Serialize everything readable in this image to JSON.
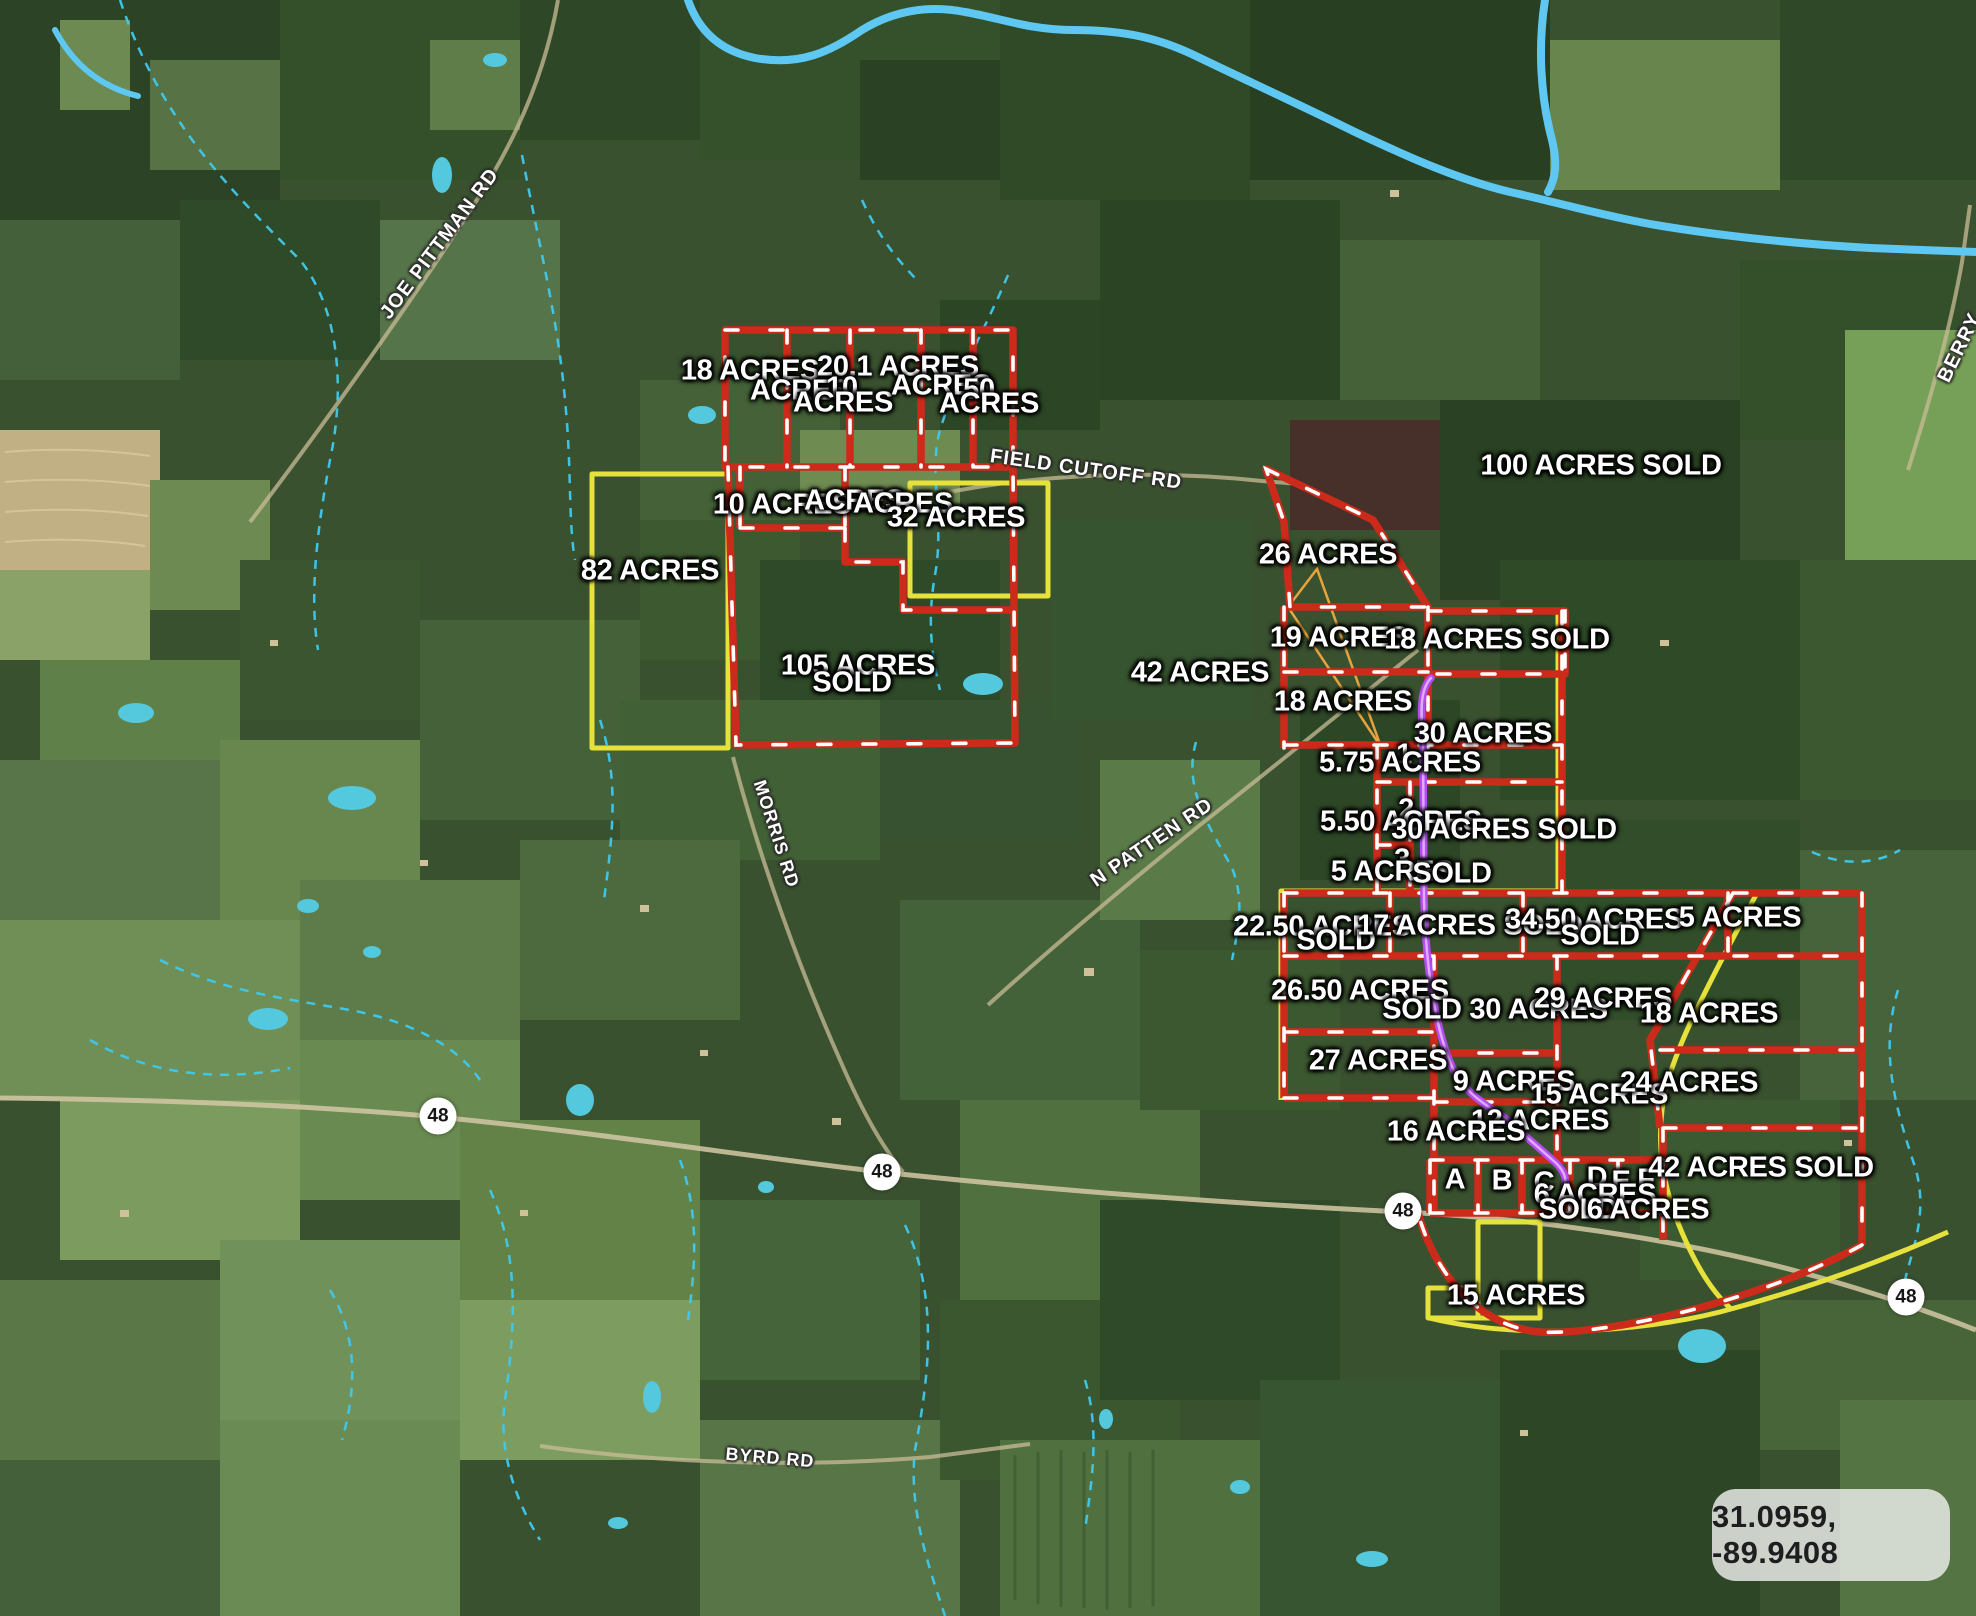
{
  "map": {
    "coordinate_badge": {
      "text": "31.0959, -89.9408"
    },
    "highway_shields": [
      {
        "label": "48",
        "x": 438,
        "y": 1116
      },
      {
        "label": "48",
        "x": 882,
        "y": 1172
      },
      {
        "label": "48",
        "x": 1403,
        "y": 1211
      },
      {
        "label": "48",
        "x": 1906,
        "y": 1297
      }
    ],
    "road_labels": [
      {
        "text": "JOE PITTMAN RD",
        "x": 440,
        "y": 244,
        "rotate": -53
      },
      {
        "text": "FIELD CUTOFF RD",
        "x": 1086,
        "y": 470,
        "rotate": 8
      },
      {
        "text": "MORRIS RD",
        "x": 776,
        "y": 834,
        "rotate": 72,
        "size": 18
      },
      {
        "text": "N PATTEN RD",
        "x": 1152,
        "y": 843,
        "rotate": -34
      },
      {
        "text": "BYRD RD",
        "x": 770,
        "y": 1458,
        "rotate": 5,
        "size": 18
      },
      {
        "text": "BERRY",
        "x": 1960,
        "y": 348,
        "rotate": -64
      }
    ],
    "parcel_labels": [
      {
        "text": "18 ACRES",
        "x": 750,
        "y": 371
      },
      {
        "text": "20.1 ACRES",
        "x": 898,
        "y": 367
      },
      {
        "text": "ACRES",
        "x": 800,
        "y": 391
      },
      {
        "text": "10",
        "x": 842,
        "y": 388
      },
      {
        "text": "ACRES",
        "x": 843,
        "y": 403
      },
      {
        "text": "ACRES",
        "x": 941,
        "y": 386
      },
      {
        "text": "50",
        "x": 979,
        "y": 390
      },
      {
        "text": "ACRES",
        "x": 989,
        "y": 404
      },
      {
        "text": "10 ACRES",
        "x": 782,
        "y": 505
      },
      {
        "text": "ACRES",
        "x": 854,
        "y": 501
      },
      {
        "text": "ACRES",
        "x": 903,
        "y": 504
      },
      {
        "text": "32 ACRES",
        "x": 956,
        "y": 518
      },
      {
        "text": "82 ACRES",
        "x": 650,
        "y": 571
      },
      {
        "text": "105 ACRES",
        "x": 858,
        "y": 666
      },
      {
        "text": "SOLD",
        "x": 852,
        "y": 683
      },
      {
        "text": "100 ACRES SOLD",
        "x": 1601,
        "y": 466
      },
      {
        "text": "26 ACRES",
        "x": 1328,
        "y": 555
      },
      {
        "text": "19 ACRES",
        "x": 1339,
        "y": 638
      },
      {
        "text": "18 ACRES SOLD",
        "x": 1497,
        "y": 640
      },
      {
        "text": "42 ACRES",
        "x": 1200,
        "y": 673
      },
      {
        "text": "18 ACRES",
        "x": 1343,
        "y": 702
      },
      {
        "text": "30 ACRES",
        "x": 1483,
        "y": 734
      },
      {
        "text": "1",
        "x": 1404,
        "y": 755
      },
      {
        "text": "5.75 ACRES",
        "x": 1400,
        "y": 763
      },
      {
        "text": "2",
        "x": 1406,
        "y": 810
      },
      {
        "text": "5.50 ACRES",
        "x": 1401,
        "y": 822
      },
      {
        "text": "30 ACRES SOLD",
        "x": 1504,
        "y": 830
      },
      {
        "text": "3",
        "x": 1402,
        "y": 860
      },
      {
        "text": "5 ACRES",
        "x": 1392,
        "y": 872
      },
      {
        "text": "SOLD",
        "x": 1452,
        "y": 874
      },
      {
        "text": "22.50 ACRES",
        "x": 1322,
        "y": 927
      },
      {
        "text": "SOLD",
        "x": 1336,
        "y": 941
      },
      {
        "text": "17 ACRES SOLD",
        "x": 1470,
        "y": 926
      },
      {
        "text": "34.50 ACRES",
        "x": 1594,
        "y": 920
      },
      {
        "text": "SOLD",
        "x": 1600,
        "y": 936
      },
      {
        "text": "5 ACRES",
        "x": 1740,
        "y": 918
      },
      {
        "text": "26.50 ACRES",
        "x": 1360,
        "y": 991
      },
      {
        "text": "SOLD 30 ACRES",
        "x": 1495,
        "y": 1010
      },
      {
        "text": "29 ACRES",
        "x": 1603,
        "y": 999
      },
      {
        "text": "18 ACRES",
        "x": 1709,
        "y": 1014
      },
      {
        "text": "27 ACRES",
        "x": 1378,
        "y": 1061
      },
      {
        "text": "9 ACRES",
        "x": 1514,
        "y": 1082
      },
      {
        "text": "15 ACRES",
        "x": 1599,
        "y": 1095
      },
      {
        "text": "24 ACRES",
        "x": 1689,
        "y": 1083
      },
      {
        "text": "12 ACRES",
        "x": 1540,
        "y": 1121
      },
      {
        "text": "16 ACRES",
        "x": 1456,
        "y": 1132
      },
      {
        "text": "A",
        "x": 1455,
        "y": 1180
      },
      {
        "text": "B",
        "x": 1502,
        "y": 1181
      },
      {
        "text": "C",
        "x": 1544,
        "y": 1183
      },
      {
        "text": "D",
        "x": 1597,
        "y": 1178
      },
      {
        "text": "E",
        "x": 1621,
        "y": 1182
      },
      {
        "text": "F",
        "x": 1646,
        "y": 1180
      },
      {
        "text": "42 ACRES SOLD",
        "x": 1761,
        "y": 1168
      },
      {
        "text": "6 ACRES",
        "x": 1595,
        "y": 1195
      },
      {
        "text": "SOLD",
        "x": 1578,
        "y": 1210
      },
      {
        "text": "6 ACRES",
        "x": 1648,
        "y": 1210
      },
      {
        "text": "15 ACRES",
        "x": 1516,
        "y": 1296
      }
    ],
    "colors": {
      "parcel_red": "#cc2a1a",
      "parcel_yellow": "#e6e23b",
      "route_purple": "#b44df0",
      "water_blue": "#5ec8f2",
      "creek_cyan": "#3fc9ee",
      "outline_orange": "#e8a33d"
    }
  }
}
